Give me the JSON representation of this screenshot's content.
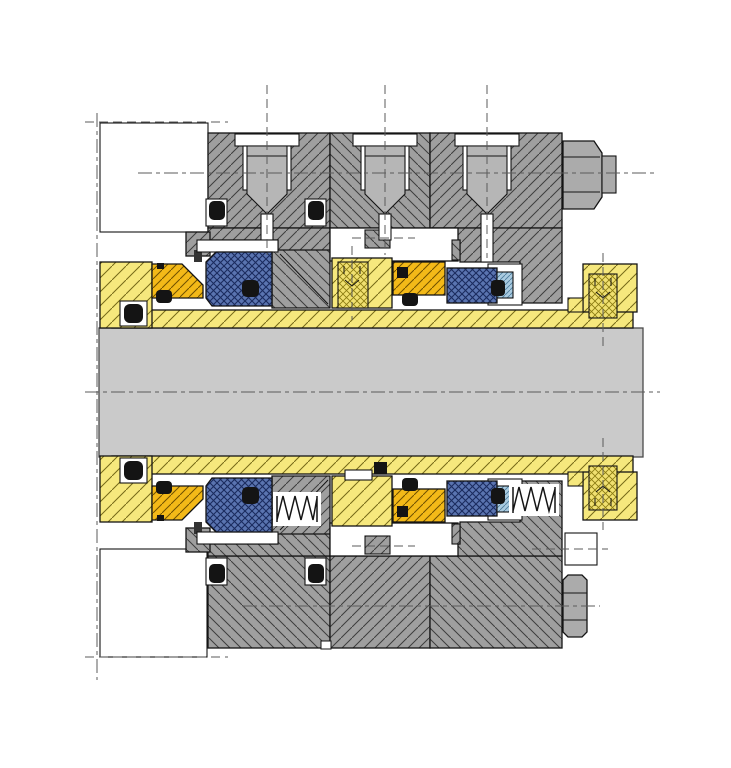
{
  "diagram": {
    "type": "engineering-cross-section",
    "subject": "dual-cartridge-mechanical-seal-on-shaft",
    "orientation": "shaft-horizontal",
    "visible_text": [],
    "components": [
      {
        "name": "shaft",
        "color_key": "shaft_gray"
      },
      {
        "name": "pump-housing-outline",
        "color_key": "white"
      },
      {
        "name": "gland-plate-inboard",
        "color_key": "housing_gray"
      },
      {
        "name": "gland-plate-center",
        "color_key": "housing_gray"
      },
      {
        "name": "gland-plate-outboard",
        "color_key": "housing_gray"
      },
      {
        "name": "flush-port-plug",
        "count": 3,
        "color_key": "plug_gray"
      },
      {
        "name": "gland-stud-nut",
        "color_key": "fastener_gray"
      },
      {
        "name": "gland-hex-bolt",
        "color_key": "fastener_gray"
      },
      {
        "name": "shaft-sleeve",
        "color_key": "sleeve_yellow"
      },
      {
        "name": "drive-collar-with-set-screw",
        "color_key": "sleeve_yellow"
      },
      {
        "name": "set-screw",
        "count": 3,
        "color_key": "screw_yellow"
      },
      {
        "name": "lock-ring",
        "count": 2,
        "color_key": "lock_orange"
      },
      {
        "name": "seal-face-ring",
        "count": 2,
        "color_key": "face_blue"
      },
      {
        "name": "stationary-seat",
        "color_key": "seat_blue"
      },
      {
        "name": "o-ring-elastomer",
        "count": 12,
        "color_key": "elastomer_black"
      },
      {
        "name": "coil-spring",
        "count": 2,
        "color_key": "outline"
      }
    ]
  },
  "colors": {
    "white": "#ffffff",
    "housing_gray": "#9f9f9f",
    "hatch_gray": "#3d3d3d",
    "shaft_gray": "#cacaca",
    "plug_gray": "#b6b6b6",
    "fastener_gray": "#ababab",
    "sleeve_yellow": "#f6e87d",
    "hatch_yellow": "#756a17",
    "screw_yellow": "#f0e070",
    "hatch_screw": "#8a7a10",
    "lock_orange": "#f3b918",
    "hatch_orange": "#6f5000",
    "face_blue": "#5a74b0",
    "hatch_blue": "#1b2b5e",
    "seat_blue": "#aacbe0",
    "hatch_seat": "#4a7a9a",
    "elastomer_black": "#141414",
    "outline": "#141414",
    "centerline": "#5b5b5b"
  }
}
